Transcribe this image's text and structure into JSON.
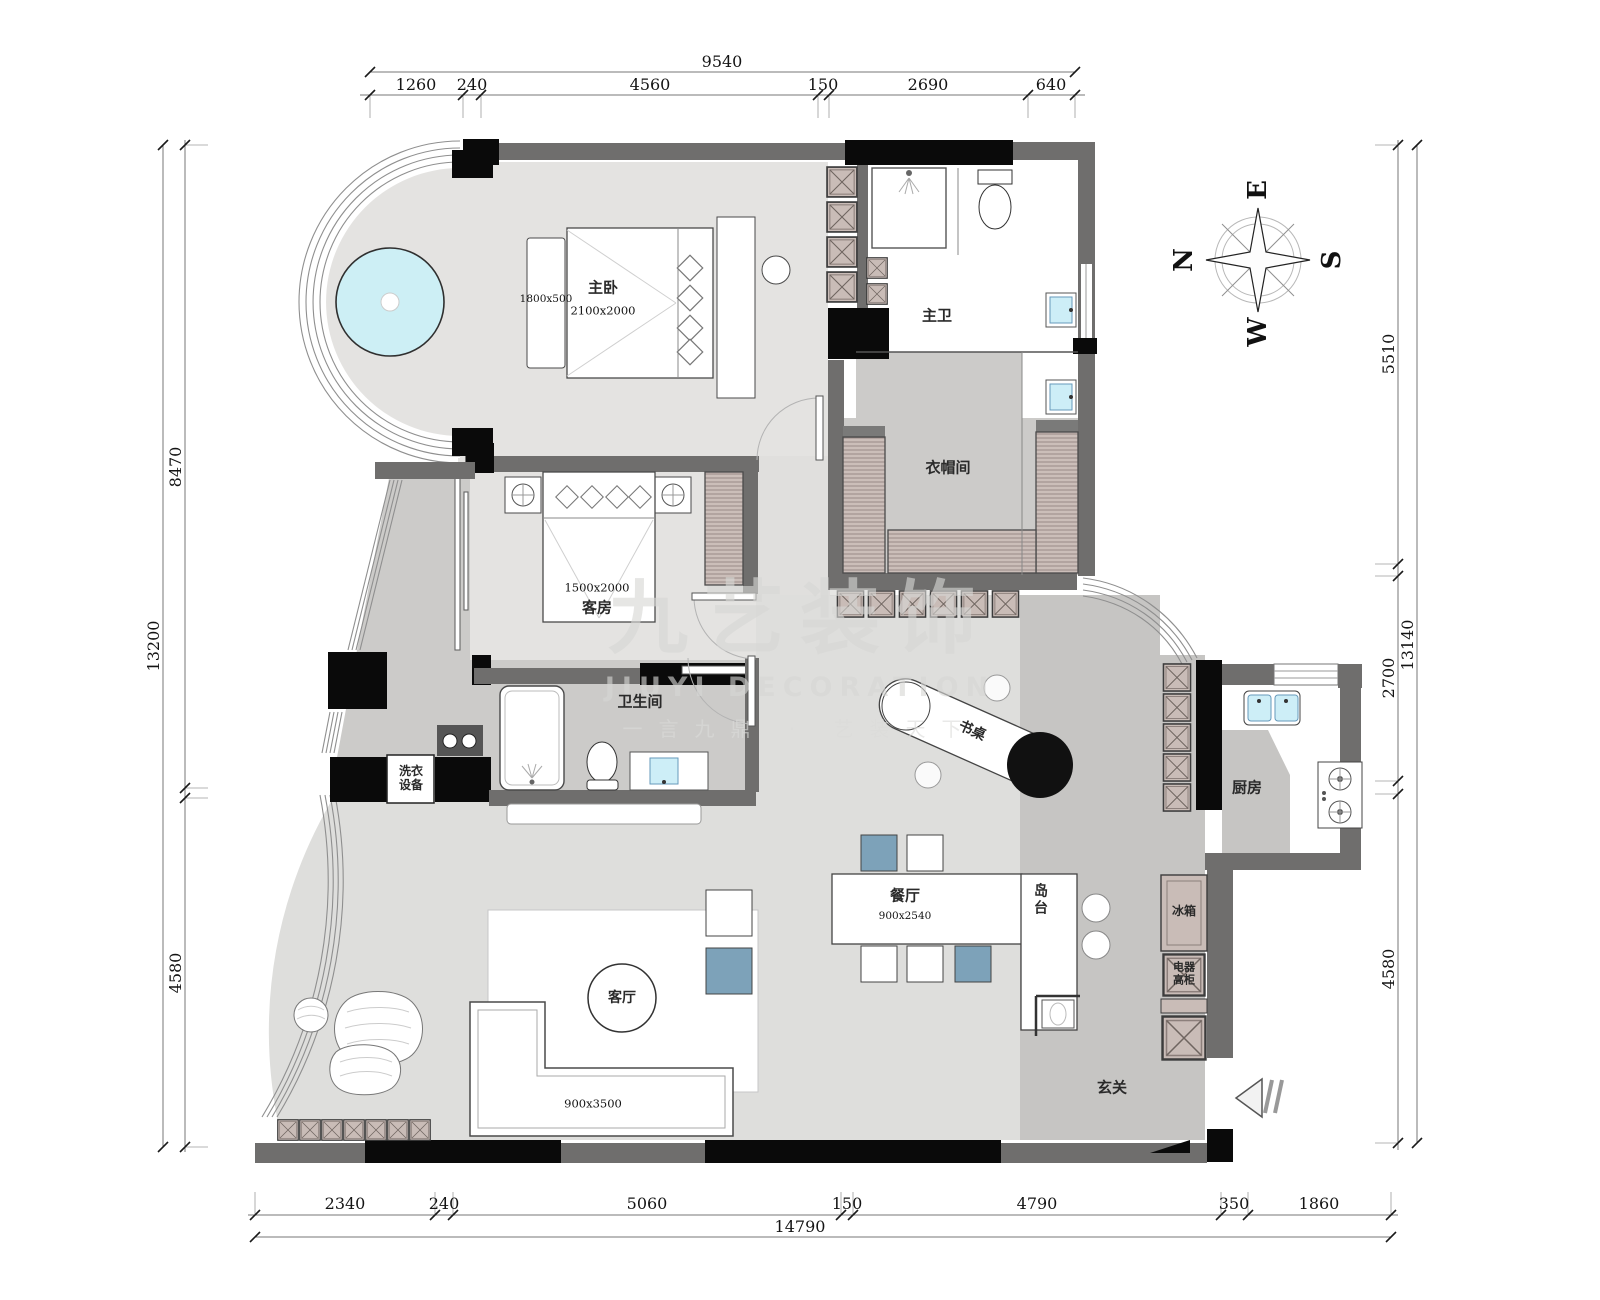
{
  "watermark": {
    "cn": "九艺装饰",
    "en": "JIUYI DECORATION",
    "slogan": "一言九鼎 · 艺装天下"
  },
  "compass": {
    "n": "N",
    "e": "E",
    "s": "S",
    "w": "W"
  },
  "rooms": {
    "master_bedroom": {
      "name": "主卧",
      "bed_size": "2100x2000",
      "bench_size": "1800x500"
    },
    "master_bath": {
      "name": "主卫"
    },
    "closet": {
      "name": "衣帽间"
    },
    "guest_room": {
      "name": "客房",
      "bed_size": "1500x2000"
    },
    "bathroom": {
      "name": "卫生间"
    },
    "laundry": {
      "line1": "洗衣",
      "line2": "设备"
    },
    "study_desk": {
      "name": "书桌"
    },
    "dining": {
      "name": "餐厅",
      "table_size": "900x2540"
    },
    "island": {
      "name": "岛台"
    },
    "kitchen": {
      "name": "厨房"
    },
    "fridge": {
      "name": "冰箱"
    },
    "appliance_cabinet": {
      "line1": "电器",
      "line2": "高柜"
    },
    "foyer": {
      "name": "玄关"
    },
    "living": {
      "name": "客厅",
      "sofa_size": "900x3500"
    }
  },
  "dimensions": {
    "top": {
      "total": "9540",
      "segments": [
        "1260",
        "240",
        "4560",
        "150",
        "2690",
        "640"
      ]
    },
    "bottom": {
      "total": "14790",
      "segments": [
        "2340",
        "240",
        "5060",
        "150",
        "4790",
        "350",
        "1860"
      ]
    },
    "left": {
      "total": "13200",
      "segments": [
        "8470",
        "4580"
      ]
    },
    "right": {
      "total": "13140",
      "segments": [
        "5510",
        "2700",
        "4580"
      ]
    }
  }
}
